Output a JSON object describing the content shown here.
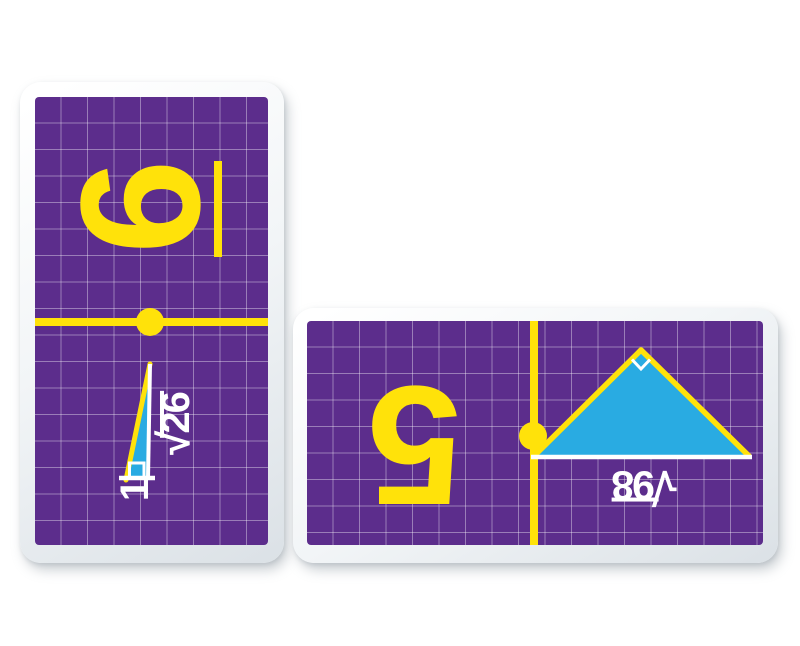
{
  "colors": {
    "card_face_purple": "#5C2D8C",
    "grid_line": "rgba(255,255,255,0.38)",
    "accent_yellow": "#FFE20A",
    "triangle_blue": "#29ABE2",
    "label_white": "#FFFFFF",
    "card_frame": "#F2F5F7"
  },
  "cards": [
    {
      "orientation": "vertical",
      "halves": [
        {
          "type": "number",
          "value": "6",
          "underlined": true,
          "rotation_deg": -90
        },
        {
          "type": "right-triangle",
          "labels": {
            "radical": "√",
            "radicand": "26",
            "leg": "1"
          },
          "rotation_deg": -90
        }
      ]
    },
    {
      "orientation": "horizontal",
      "halves": [
        {
          "type": "number",
          "value": "5",
          "underlined": false,
          "rotation_deg": 180
        },
        {
          "type": "right-triangle",
          "labels": {
            "radical": "√",
            "radicand": "98"
          },
          "rotation_deg": 180
        }
      ]
    }
  ]
}
